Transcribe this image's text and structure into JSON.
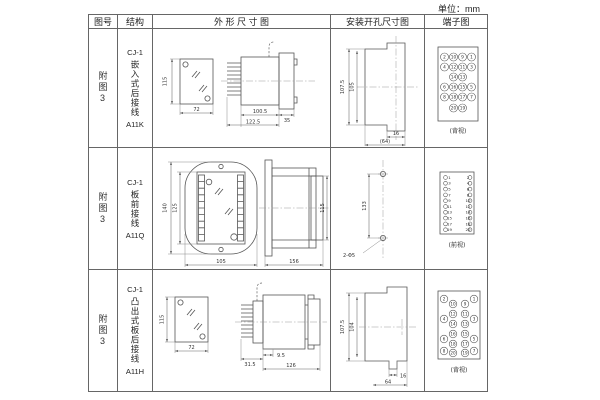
{
  "unit_label": "单位：mm",
  "headers": {
    "fig_no": "图号",
    "structure": "结构",
    "outline": "外 形 尺 寸 图",
    "mounting": "安装开孔尺寸图",
    "terminal": "端子图"
  },
  "rows": [
    {
      "fig_no": "附图3",
      "model_top": "CJ-1",
      "structure_text": "嵌入式后接线",
      "model_code": "A11K",
      "outline": {
        "d_height": "115",
        "d_width": "72",
        "d_body": "100.5",
        "d_total": "122.5",
        "d_flange": "35"
      },
      "mounting": {
        "d_outer": "107.5",
        "d_inner": "105",
        "d_notch": "16",
        "d_width": "(64)"
      },
      "terminal_caption": "(背视)",
      "terminals": [
        2,
        10,
        9,
        1,
        4,
        12,
        11,
        3,
        14,
        13,
        6,
        16,
        15,
        5,
        8,
        18,
        17,
        7,
        20,
        19
      ]
    },
    {
      "fig_no": "附图3",
      "model_top": "CJ-1",
      "structure_text": "板前接线",
      "model_code": "A11Q",
      "outline": {
        "d_outer_h": "140",
        "d_inner_h": "125",
        "d_width": "105",
        "d_len": "156",
        "d_side_h": "115"
      },
      "mounting": {
        "d_span": "133",
        "d_holes": "2-Φ5"
      },
      "terminal_caption": "(前视)",
      "terminals_left": [
        1,
        3,
        5,
        7,
        9,
        11,
        13,
        15,
        17,
        19
      ],
      "terminals_right": [
        2,
        4,
        6,
        8,
        10,
        12,
        14,
        16,
        18,
        20
      ]
    },
    {
      "fig_no": "附图3",
      "model_top": "CJ-1",
      "structure_text": "凸出式板后接线",
      "model_code": "A11H",
      "outline": {
        "d_height": "115",
        "d_width": "72",
        "d_a": "31.5",
        "d_b": "9.5",
        "d_len": "126"
      },
      "mounting": {
        "d_outer": "107.5",
        "d_inner": "104",
        "d_notch": "16",
        "d_width": "64"
      },
      "terminal_caption": "(背视)",
      "terminals": [
        2,
        10,
        9,
        1,
        12,
        11,
        4,
        14,
        13,
        3,
        16,
        15,
        6,
        18,
        17,
        5,
        8,
        20,
        19,
        7
      ]
    }
  ]
}
